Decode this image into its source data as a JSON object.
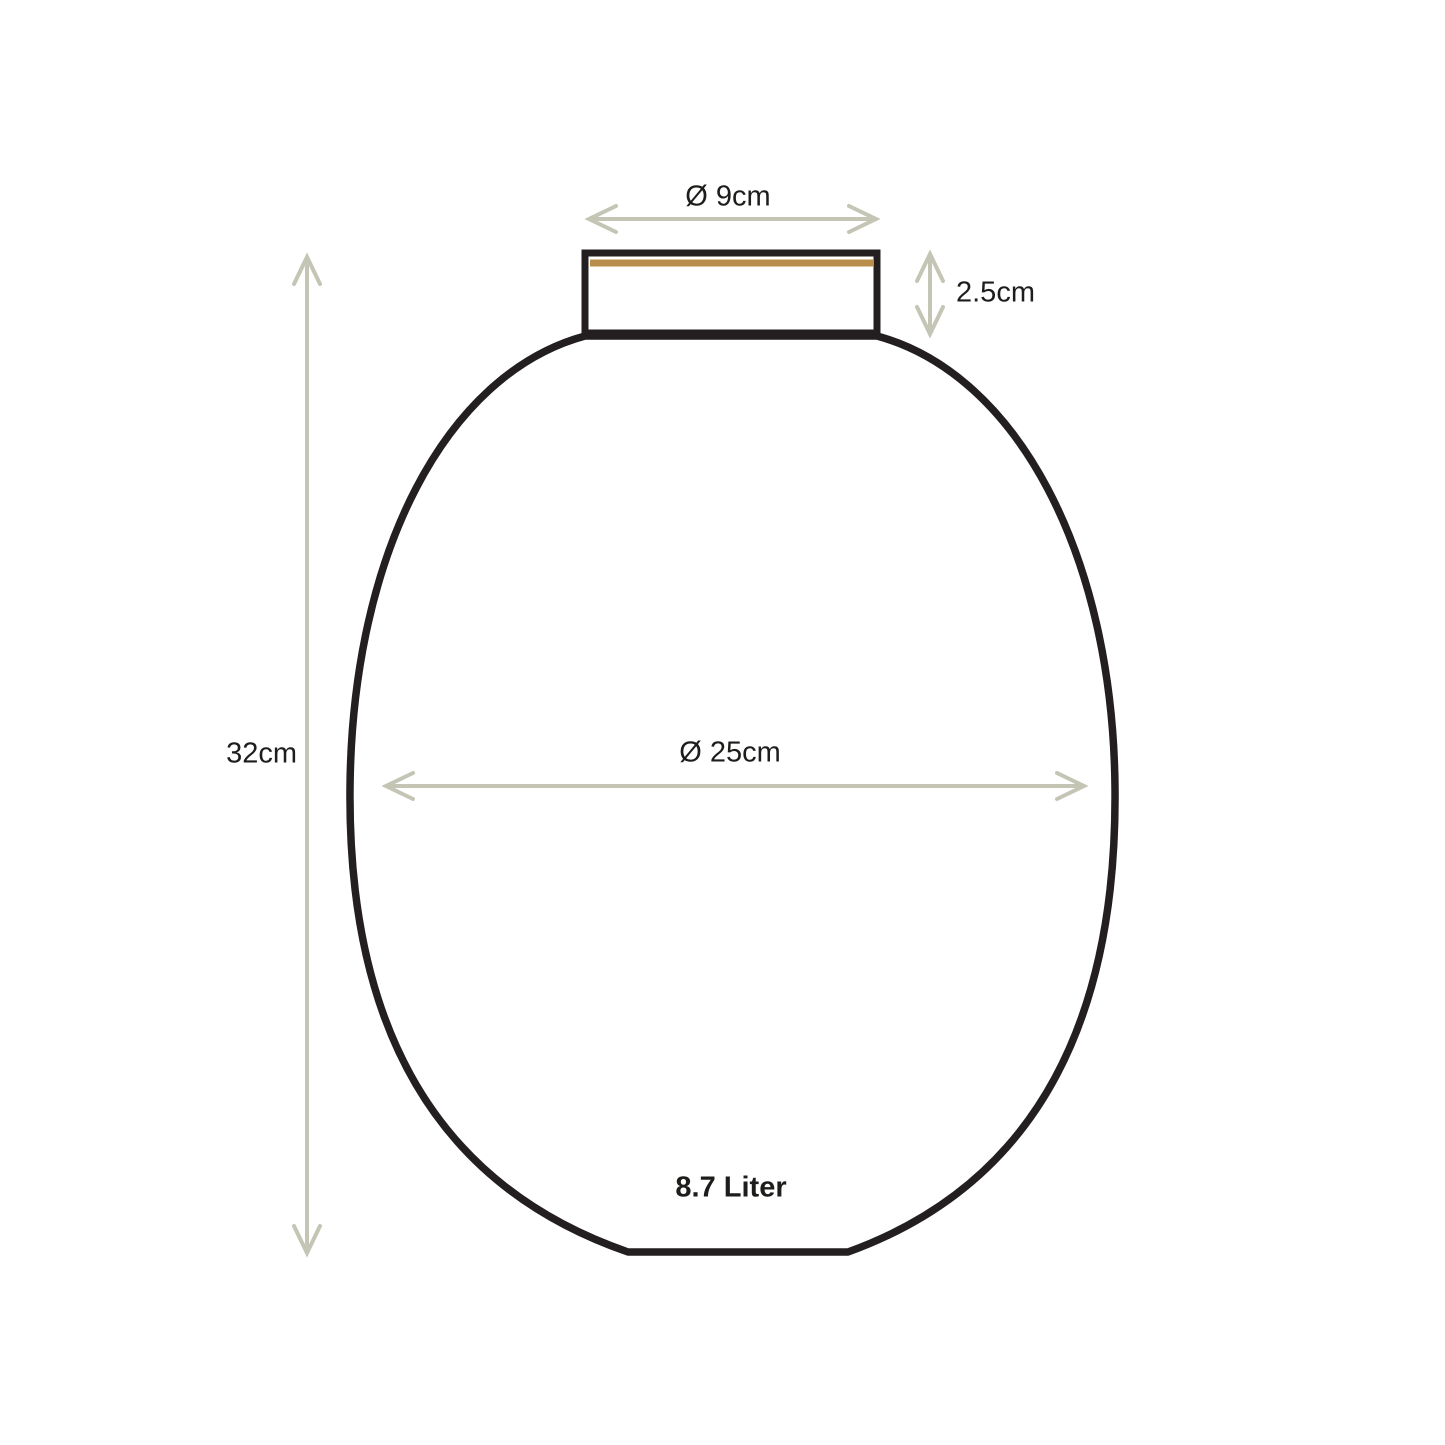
{
  "measurements": [
    {
      "id": "opening-diameter",
      "label": "Ø 9cm"
    },
    {
      "id": "neck-height",
      "label": "2.5cm"
    },
    {
      "id": "total-height",
      "label": "32cm"
    },
    {
      "id": "body-diameter",
      "label": "Ø 25cm"
    },
    {
      "id": "volume",
      "label": "8.7 Liter"
    }
  ],
  "colors": {
    "background": "#ffffff",
    "outline": "#231f20",
    "arrow": "#c4c5b5",
    "rim_accent": "#b98d4a",
    "text": "#1d1d1b"
  }
}
